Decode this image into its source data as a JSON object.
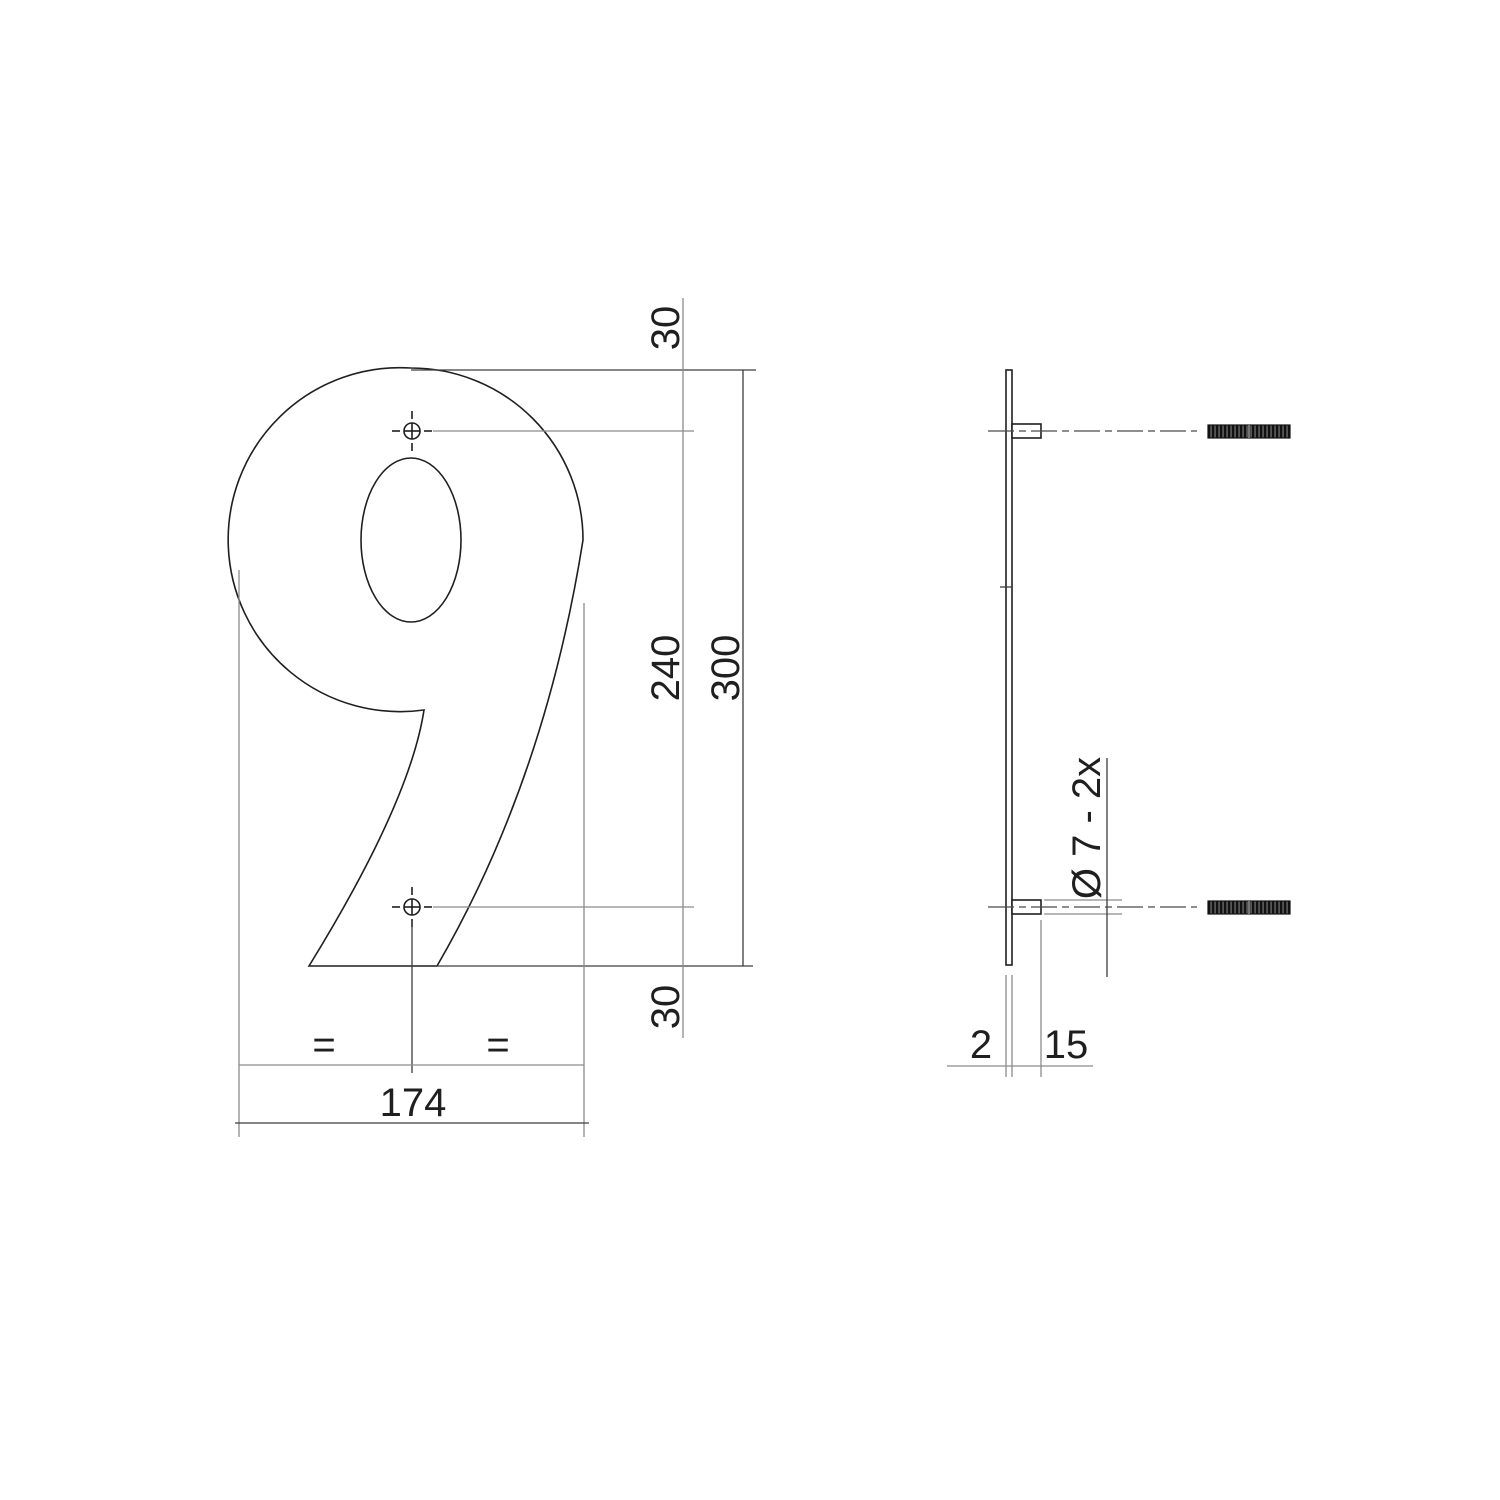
{
  "drawing": {
    "title": "House number 9 dimensional drawing",
    "numeral": "9",
    "colors": {
      "background": "#ffffff",
      "object_line": "#1f1f1f",
      "dimension_dark": "#3d3d3d",
      "dimension_gray": "#8c8c8c",
      "text": "#1f1f1f",
      "thread_fill": "#555555",
      "thread_stripe": "#111111"
    },
    "front_view": {
      "top_offset": "30",
      "hole_spacing": "240",
      "overall_height": "300",
      "bottom_offset": "30",
      "overall_width": "174",
      "equal_left": "=",
      "equal_right": "="
    },
    "side_view": {
      "thickness": "2",
      "pin_length": "15",
      "hole_note": "Ø 7 - 2x"
    }
  }
}
